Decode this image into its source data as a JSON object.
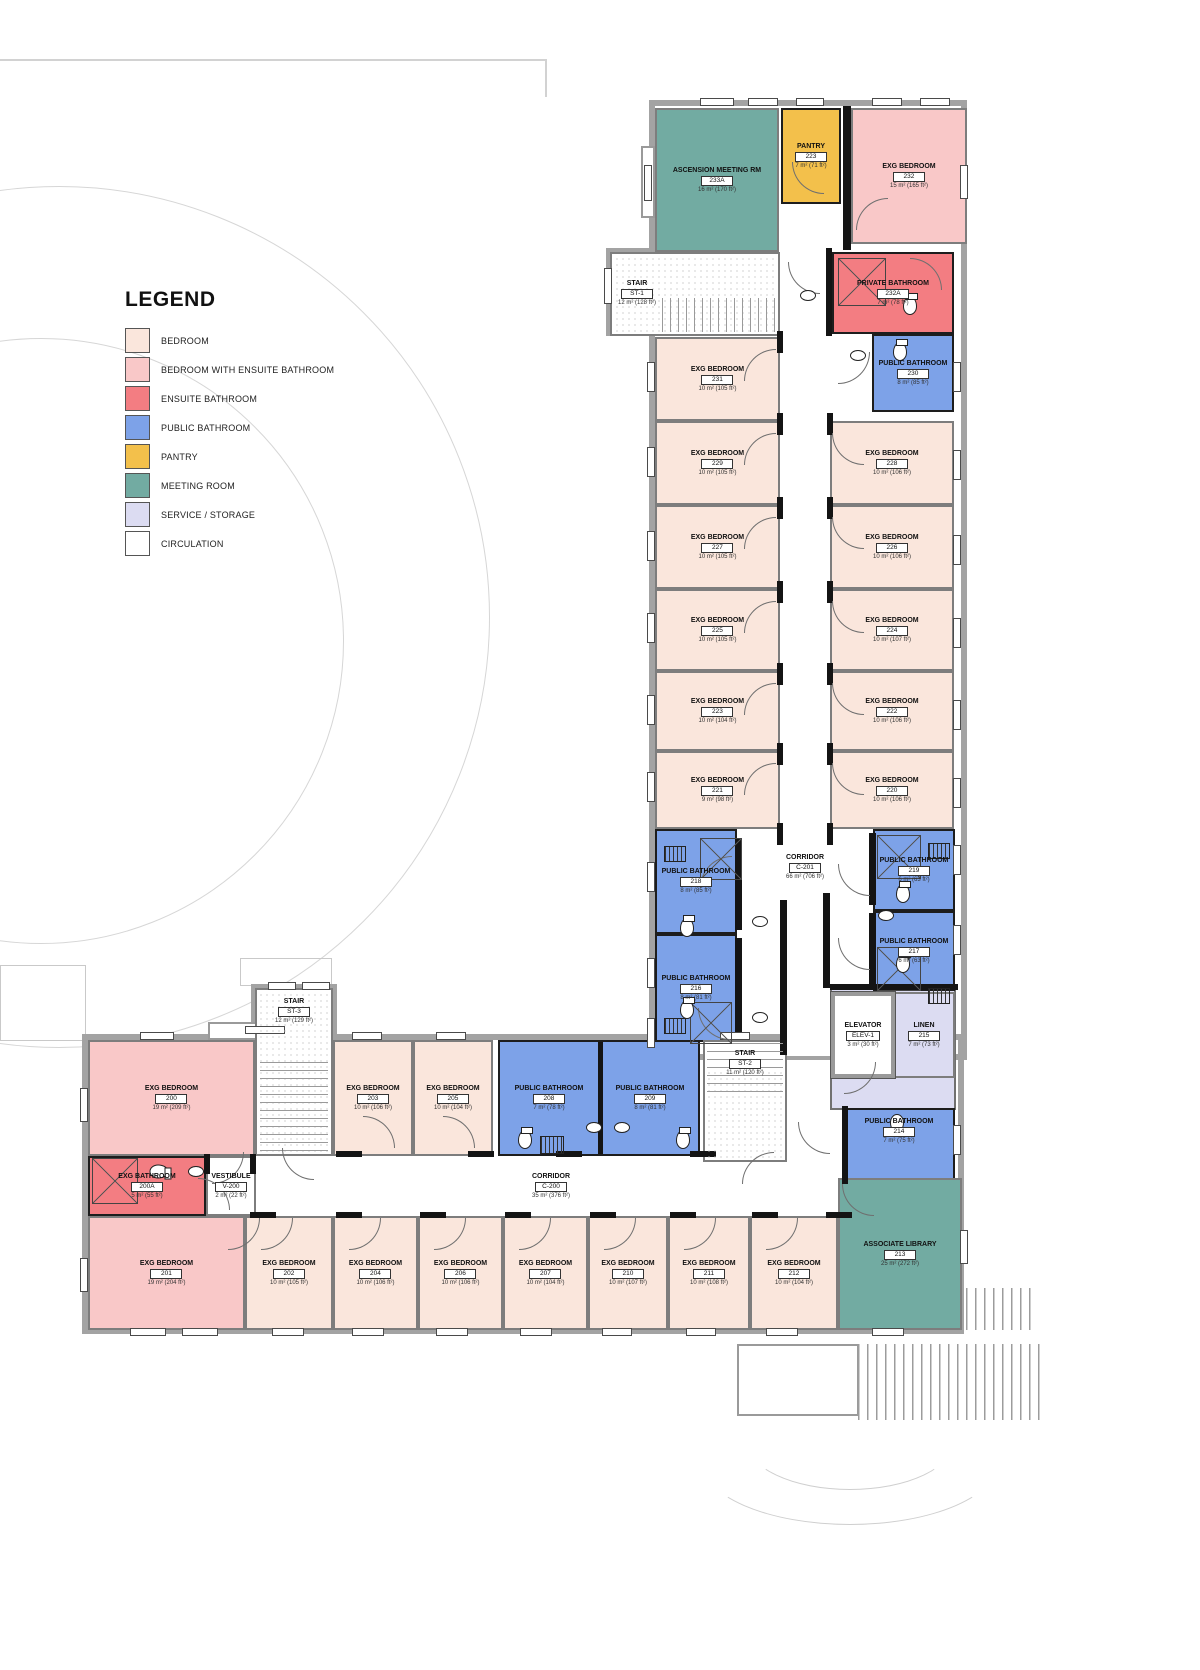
{
  "legend": {
    "title": "LEGEND",
    "items": [
      {
        "label": "BEDROOM",
        "color": "#fae6dc",
        "type": "bedroom"
      },
      {
        "label": "BEDROOM WITH ENSUITE BATHROOM",
        "color": "#f9c8c8",
        "type": "bedroom_ensuite"
      },
      {
        "label": "ENSUITE BATHROOM",
        "color": "#f37d82",
        "type": "ensuite_bath"
      },
      {
        "label": "PUBLIC BATHROOM",
        "color": "#7da2e8",
        "type": "public_bath"
      },
      {
        "label": "PANTRY",
        "color": "#f3c04b",
        "type": "pantry"
      },
      {
        "label": "MEETING ROOM",
        "color": "#72aba2",
        "type": "meeting"
      },
      {
        "label": "SERVICE / STORAGE",
        "color": "#dcdcf2",
        "type": "service"
      },
      {
        "label": "CIRCULATION",
        "color": "#ffffff",
        "type": "circulation"
      }
    ]
  },
  "colors": {
    "bedroom": "#fae6dc",
    "bedroom_ensuite": "#f9c8c8",
    "ensuite_bath": "#f37d82",
    "public_bath": "#7da2e8",
    "pantry": "#f3c04b",
    "meeting": "#72aba2",
    "service": "#dcdcf2",
    "circulation": "#ffffff",
    "stair": "#ffffff"
  },
  "rooms": {
    "corridor_c201": {
      "name": "CORRIDOR",
      "number": "C-201",
      "area": "66 m² (706 ft²)",
      "type": "circulation"
    },
    "corridor_c200": {
      "name": "CORRIDOR",
      "number": "C-200",
      "area": "35 m² (376 ft²)",
      "type": "circulation"
    },
    "meeting_233a": {
      "name": "ASCENSION MEETING RM",
      "number": "233A",
      "area": "16 m² (170 ft²)",
      "type": "meeting"
    },
    "pantry_223": {
      "name": "PANTRY",
      "number": "223",
      "area": "7 m² (71 ft²)",
      "type": "pantry"
    },
    "bedroom_232": {
      "name": "EXG BEDROOM",
      "number": "232",
      "area": "15 m² (165 ft²)",
      "type": "bedroom_ensuite"
    },
    "stair_st1": {
      "name": "STAIR",
      "number": "ST-1",
      "area": "12 m² (128 ft²)",
      "type": "stair"
    },
    "private_bath_232a": {
      "name": "PRIVATE BATHROOM",
      "number": "232A",
      "area": "7 m² (78 ft²)",
      "type": "ensuite_bath"
    },
    "public_bath_230": {
      "name": "PUBLIC BATHROOM",
      "number": "230",
      "area": "8 m² (85 ft²)",
      "type": "public_bath"
    },
    "bedroom_231": {
      "name": "EXG BEDROOM",
      "number": "231",
      "area": "10 m² (105 ft²)",
      "type": "bedroom"
    },
    "bedroom_229": {
      "name": "EXG BEDROOM",
      "number": "229",
      "area": "10 m² (105 ft²)",
      "type": "bedroom"
    },
    "bedroom_227": {
      "name": "EXG BEDROOM",
      "number": "227",
      "area": "10 m² (105 ft²)",
      "type": "bedroom"
    },
    "bedroom_225": {
      "name": "EXG BEDROOM",
      "number": "225",
      "area": "10 m² (105 ft²)",
      "type": "bedroom"
    },
    "bedroom_223": {
      "name": "EXG BEDROOM",
      "number": "223",
      "area": "10 m² (104 ft²)",
      "type": "bedroom"
    },
    "bedroom_221": {
      "name": "EXG BEDROOM",
      "number": "221",
      "area": "9 m² (98 ft²)",
      "type": "bedroom"
    },
    "bedroom_228": {
      "name": "EXG BEDROOM",
      "number": "228",
      "area": "10 m² (106 ft²)",
      "type": "bedroom"
    },
    "bedroom_226": {
      "name": "EXG BEDROOM",
      "number": "226",
      "area": "10 m² (106 ft²)",
      "type": "bedroom"
    },
    "bedroom_224": {
      "name": "EXG BEDROOM",
      "number": "224",
      "area": "10 m² (107 ft²)",
      "type": "bedroom"
    },
    "bedroom_222": {
      "name": "EXG BEDROOM",
      "number": "222",
      "area": "10 m² (106 ft²)",
      "type": "bedroom"
    },
    "bedroom_220": {
      "name": "EXG BEDROOM",
      "number": "220",
      "area": "10 m² (106 ft²)",
      "type": "bedroom"
    },
    "public_bath_218": {
      "name": "PUBLIC BATHROOM",
      "number": "218",
      "area": "8 m² (85 ft²)",
      "type": "public_bath"
    },
    "public_bath_216": {
      "name": "PUBLIC BATHROOM",
      "number": "216",
      "area": "8 m² (81 ft²)",
      "type": "public_bath"
    },
    "public_bath_219": {
      "name": "PUBLIC BATHROOM",
      "number": "219",
      "area": "6 m² (63 ft²)",
      "type": "public_bath"
    },
    "public_bath_217": {
      "name": "PUBLIC BATHROOM",
      "number": "217",
      "area": "6 m² (63 ft²)",
      "type": "public_bath"
    },
    "linen_215": {
      "name": "LINEN",
      "number": "215",
      "area": "7 m² (73 ft²)",
      "type": "service"
    },
    "elevator": {
      "name": "ELEVATOR",
      "number": "ELEV-1",
      "area": "3 m² (30 ft²)",
      "type": "circulation"
    },
    "public_bath_214": {
      "name": "PUBLIC BATHROOM",
      "number": "214",
      "area": "7 m² (75 ft²)",
      "type": "public_bath"
    },
    "stair_st3": {
      "name": "STAIR",
      "number": "ST-3",
      "area": "12 m² (129 ft²)",
      "type": "stair"
    },
    "bedroom_200": {
      "name": "EXG BEDROOM",
      "number": "200",
      "area": "19 m² (209 ft²)",
      "type": "bedroom_ensuite"
    },
    "bath_200a": {
      "name": "EXG BATHROOM",
      "number": "200A",
      "area": "5 m² (55 ft²)",
      "type": "ensuite_bath"
    },
    "vestibule_v200": {
      "name": "VESTIBULE",
      "number": "V-200",
      "area": "2 m² (22 ft²)",
      "type": "circulation"
    },
    "bedroom_203": {
      "name": "EXG BEDROOM",
      "number": "203",
      "area": "10 m² (106 ft²)",
      "type": "bedroom"
    },
    "bedroom_205": {
      "name": "EXG BEDROOM",
      "number": "205",
      "area": "10 m² (104 ft²)",
      "type": "bedroom"
    },
    "public_bath_208": {
      "name": "PUBLIC BATHROOM",
      "number": "208",
      "area": "7 m² (78 ft²)",
      "type": "public_bath"
    },
    "public_bath_209": {
      "name": "PUBLIC BATHROOM",
      "number": "209",
      "area": "8 m² (81 ft²)",
      "type": "public_bath"
    },
    "stair_st2": {
      "name": "STAIR",
      "number": "ST-2",
      "area": "11 m² (120 ft²)",
      "type": "stair"
    },
    "bedroom_201": {
      "name": "EXG BEDROOM",
      "number": "201",
      "area": "19 m² (204 ft²)",
      "type": "bedroom_ensuite"
    },
    "bedroom_202": {
      "name": "EXG BEDROOM",
      "number": "202",
      "area": "10 m² (105 ft²)",
      "type": "bedroom"
    },
    "bedroom_204": {
      "name": "EXG BEDROOM",
      "number": "204",
      "area": "10 m² (106 ft²)",
      "type": "bedroom"
    },
    "bedroom_206": {
      "name": "EXG BEDROOM",
      "number": "206",
      "area": "10 m² (106 ft²)",
      "type": "bedroom"
    },
    "bedroom_207": {
      "name": "EXG BEDROOM",
      "number": "207",
      "area": "10 m² (104 ft²)",
      "type": "bedroom"
    },
    "bedroom_210": {
      "name": "EXG BEDROOM",
      "number": "210",
      "area": "10 m² (107 ft²)",
      "type": "bedroom"
    },
    "bedroom_211": {
      "name": "EXG BEDROOM",
      "number": "211",
      "area": "10 m² (108 ft²)",
      "type": "bedroom"
    },
    "bedroom_212": {
      "name": "EXG BEDROOM",
      "number": "212",
      "area": "10 m² (104 ft²)",
      "type": "bedroom"
    },
    "library_213": {
      "name": "ASSOCIATE LIBRARY",
      "number": "213",
      "area": "25 m² (272 ft²)",
      "type": "meeting"
    }
  }
}
